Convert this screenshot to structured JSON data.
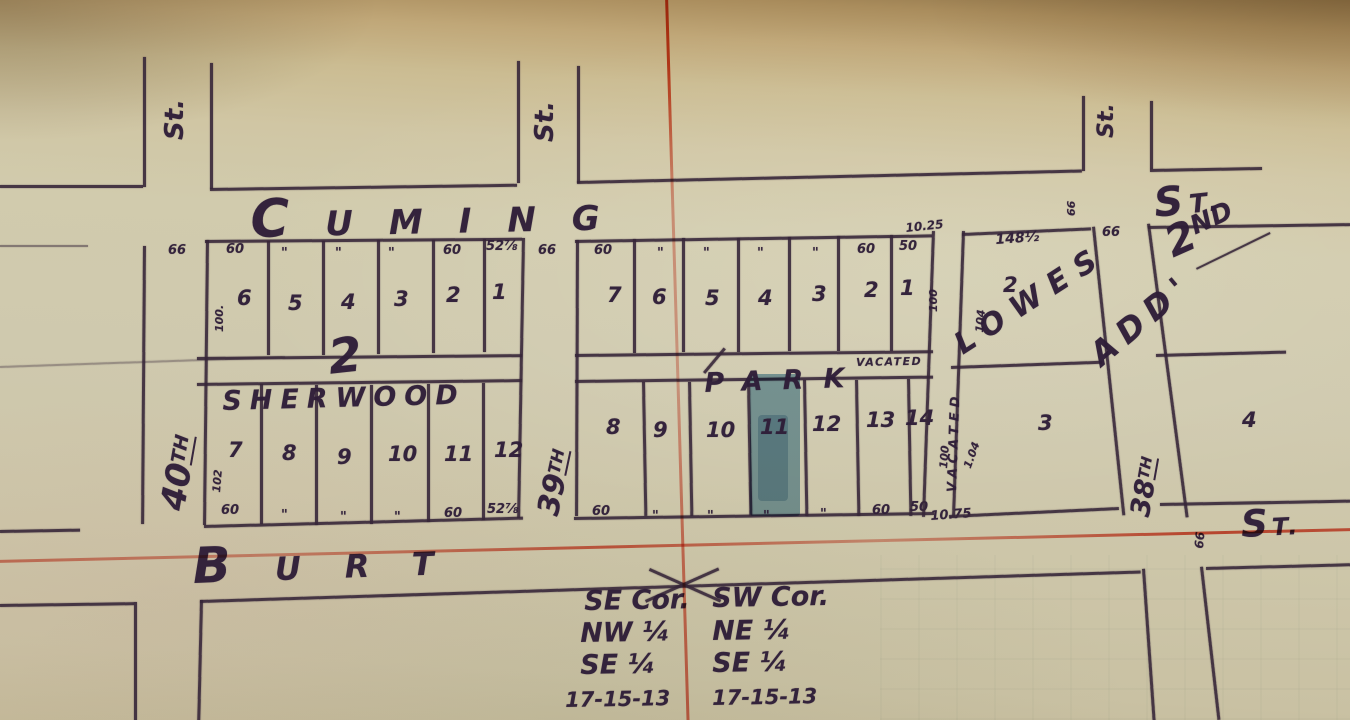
{
  "colors": {
    "ink": "#43324a",
    "red_line": "#d84b31",
    "lot_highlight": "#3f87b0",
    "paper": "#cfc8ab"
  },
  "streets": {
    "stub_label": "St.",
    "cuming": "CUMING",
    "cuming_st": "ST.",
    "burt": "BURT",
    "burt_st": "ST.",
    "s40_num": "40",
    "s40_suf": "TH",
    "s39_num": "39",
    "s39_suf": "TH",
    "s38_num": "38",
    "s38_suf": "TH"
  },
  "subdivision": {
    "sherwood": "SHERWOOD",
    "park": "PARK",
    "block_number": "2",
    "lowes": "LOWES",
    "second_num": "2",
    "second_suf": "ND",
    "add": "ADD'"
  },
  "vacated": {
    "vertical": "VACATED",
    "horizontal": "VACATED",
    "top_width": "10.25",
    "bottom_width": "10.75",
    "depth_nw": "100",
    "depth_ne": "104",
    "depth_sw": "100",
    "depth_se": "1.04"
  },
  "lots": {
    "sherwood_top": [
      "6",
      "5",
      "4",
      "3",
      "2",
      "1"
    ],
    "sherwood_bottom": [
      "7",
      "8",
      "9",
      "10",
      "11",
      "12"
    ],
    "park_top": [
      "7",
      "6",
      "5",
      "4",
      "3",
      "2",
      "1"
    ],
    "park_bottom": [
      "8",
      "9",
      "10",
      "11",
      "12",
      "13",
      "14"
    ],
    "lowes_top": "2",
    "lowes_bottom": "3",
    "east_block": "4"
  },
  "dims": {
    "sherwood_top": [
      "60",
      "\"",
      "\"",
      "\"",
      "60",
      "52⅞"
    ],
    "sherwood_bottom": [
      "60",
      "\"",
      "\"",
      "\"",
      "60",
      "52⅞"
    ],
    "park_top": [
      "60",
      "\"",
      "\"",
      "\"",
      "\"",
      "60",
      "50"
    ],
    "park_bottom": [
      "60",
      "\"",
      "\"",
      "\"",
      "\"",
      "60",
      "50"
    ],
    "lowes_top": "148½",
    "sherwood_depth_top": "100.",
    "sherwood_depth_bottom": "102",
    "sixtysix": "66"
  },
  "corner_note": {
    "col1": [
      "SE Cor.",
      "NW ¼",
      "SE ¼",
      "17-15-13"
    ],
    "col2": [
      "SW Cor.",
      "NE ¼",
      "SE ¼",
      "17-15-13"
    ]
  }
}
